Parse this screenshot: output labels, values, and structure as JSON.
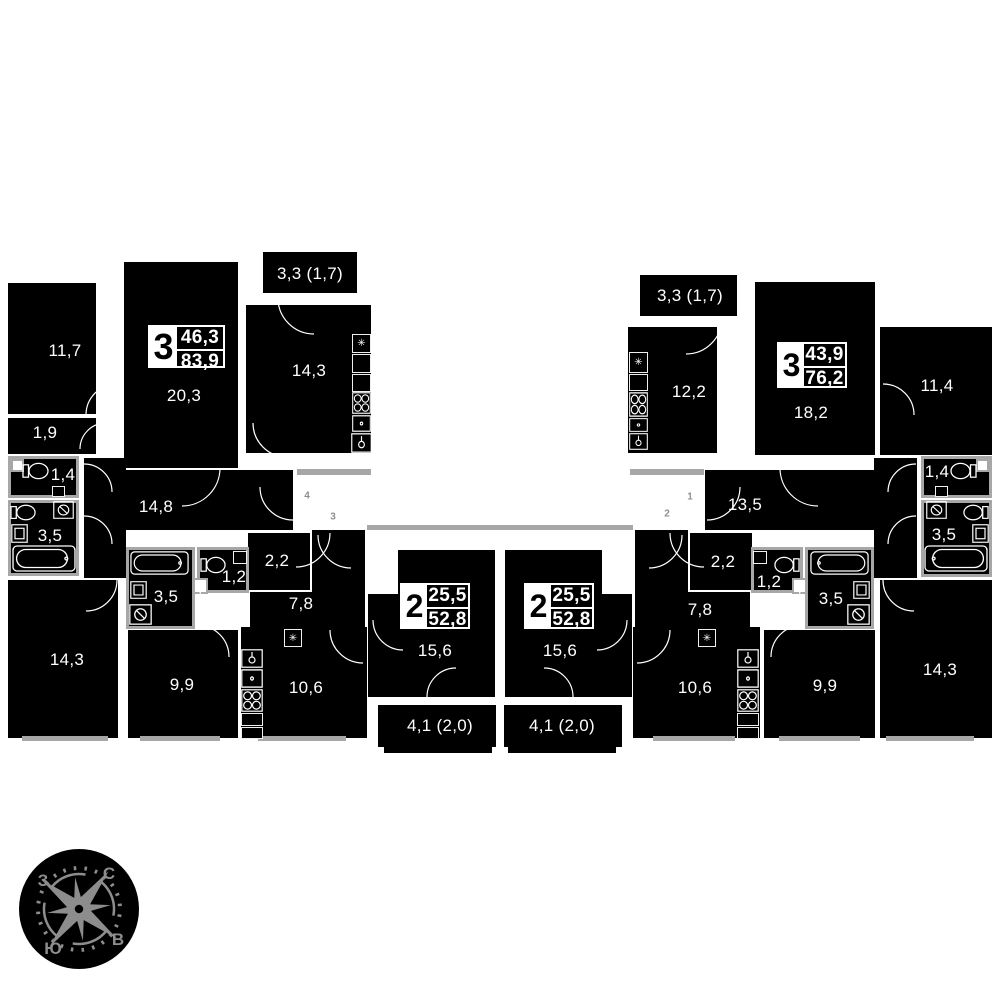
{
  "apartments": [
    {
      "rooms": "3",
      "living": "46,3",
      "total": "83,9"
    },
    {
      "rooms": "2",
      "living": "25,5",
      "total": "52,8"
    },
    {
      "rooms": "2",
      "living": "25,5",
      "total": "52,8"
    },
    {
      "rooms": "3",
      "living": "43,9",
      "total": "76,2"
    }
  ],
  "labels": {
    "left_room_11_7": "11,7",
    "left_room_1_9": "1,9",
    "left_wc_1_4": "1,4",
    "left_bath_3_5": "3,5",
    "left_hall_14_8": "14,8",
    "left_room_20_3": "20,3",
    "left_balcony": "3,3 (1,7)",
    "left_kitchen_14_3": "14,3",
    "left_room_14_3": "14,3",
    "left2_bath_3_5": "3,5",
    "left2_wc_1_2": "1,2",
    "left2_storage_2_2": "2,2",
    "left2_hall_7_8": "7,8",
    "left2_room_9_9": "9,9",
    "left2_kitchen_10_6": "10,6",
    "mid_left_room_15_6": "15,6",
    "mid_left_balcony": "4,1 (2,0)",
    "mid_right_room_15_6": "15,6",
    "mid_right_balcony": "4,1 (2,0)",
    "right2_storage_2_2": "2,2",
    "right2_wc_1_2": "1,2",
    "right2_bath_3_5": "3,5",
    "right2_hall_7_8": "7,8",
    "right2_kitchen_10_6": "10,6",
    "right2_room_9_9": "9,9",
    "right_room_14_3": "14,3",
    "right_balcony": "3,3 (1,7)",
    "right_kitchen_12_2": "12,2",
    "right_room_18_2": "18,2",
    "right_room_11_4": "11,4",
    "right_hall_13_5": "13,5",
    "right_wc_1_4": "1,4",
    "right_bath_3_5": "3,5"
  },
  "corridor_units": [
    "4",
    "3",
    "1",
    "2"
  ],
  "compass": {
    "north": "С",
    "east": "В",
    "south": "Ю",
    "west": "З"
  },
  "icons": {
    "fridge_glyph": "✳"
  }
}
